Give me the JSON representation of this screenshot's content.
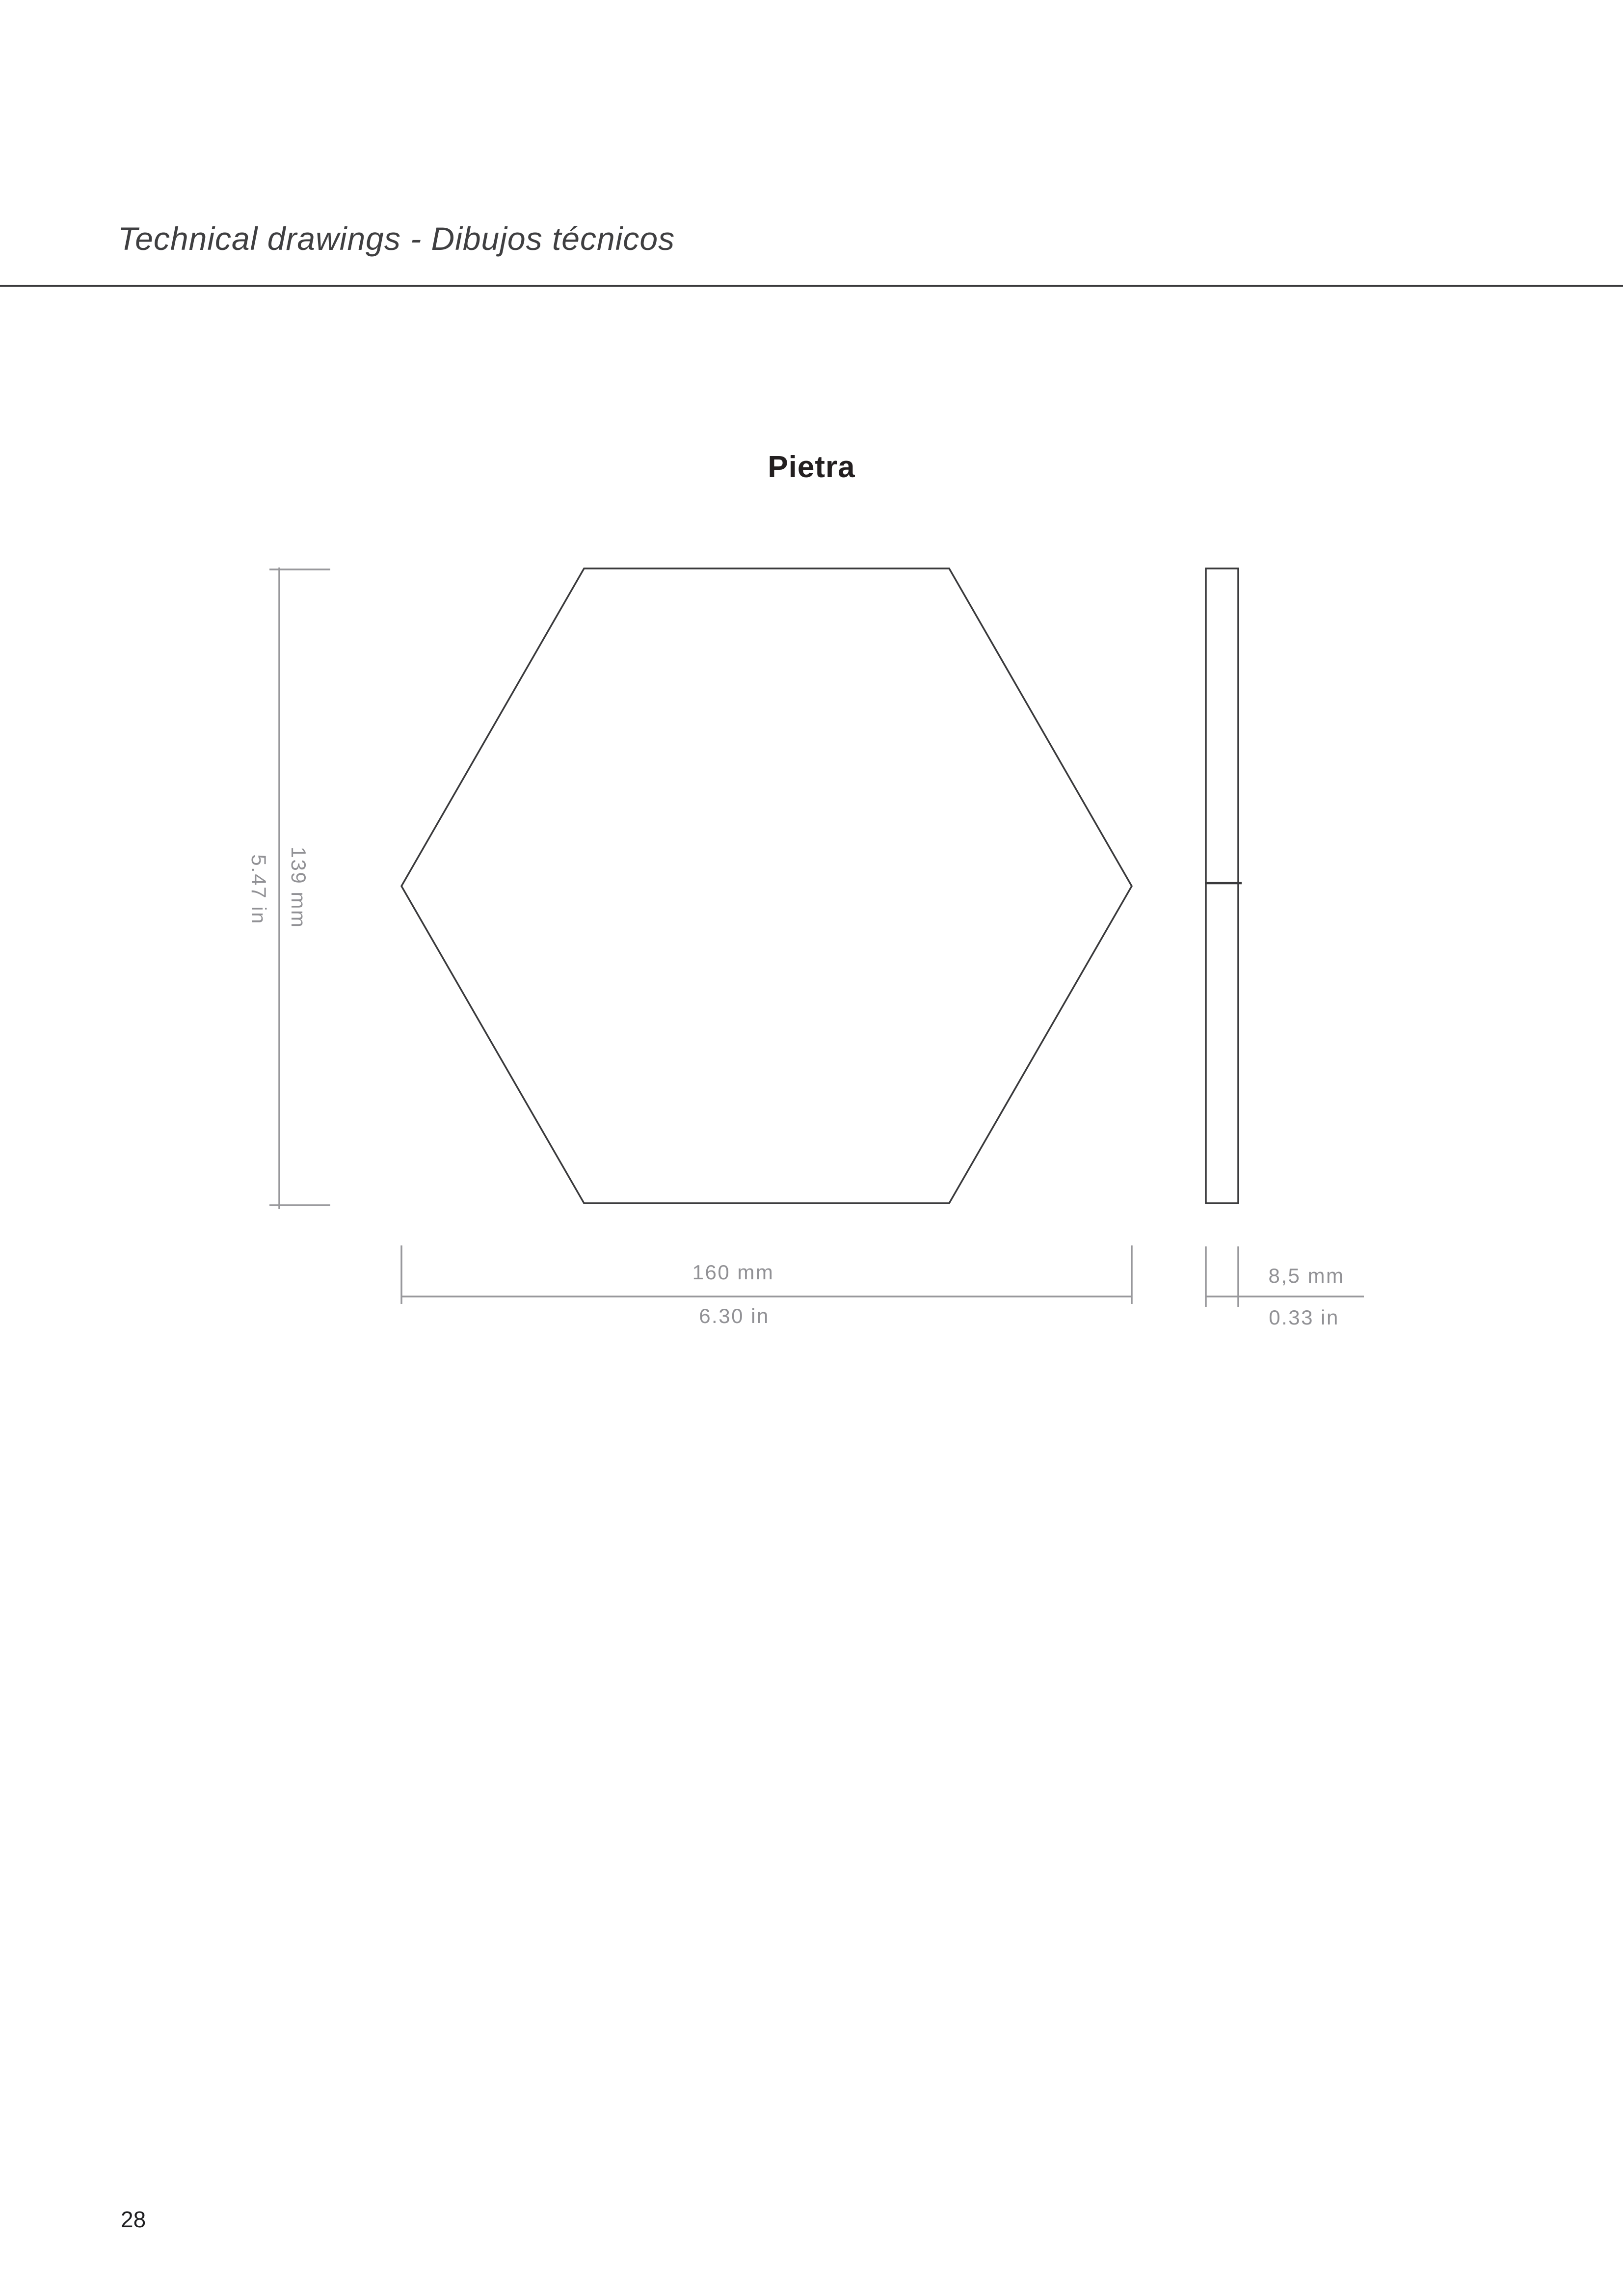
{
  "page": {
    "header_title": "Technical drawings - Dibujos técnicos",
    "page_number": "28"
  },
  "drawing": {
    "title": "Pietra",
    "front_view": {
      "shape": "hexagon",
      "height_mm": "139 mm",
      "height_in": "5.47 in",
      "width_mm": "160 mm",
      "width_in": "6.30 in"
    },
    "side_view": {
      "thickness_mm": "8,5 mm",
      "thickness_in": "0.33 in"
    }
  },
  "colors": {
    "outline": "#3a3a3c",
    "dimension_line": "#98989c",
    "dimension_text": "#919195",
    "title_text": "#231f20",
    "header_text": "#3f3f41",
    "background": "#ffffff"
  }
}
